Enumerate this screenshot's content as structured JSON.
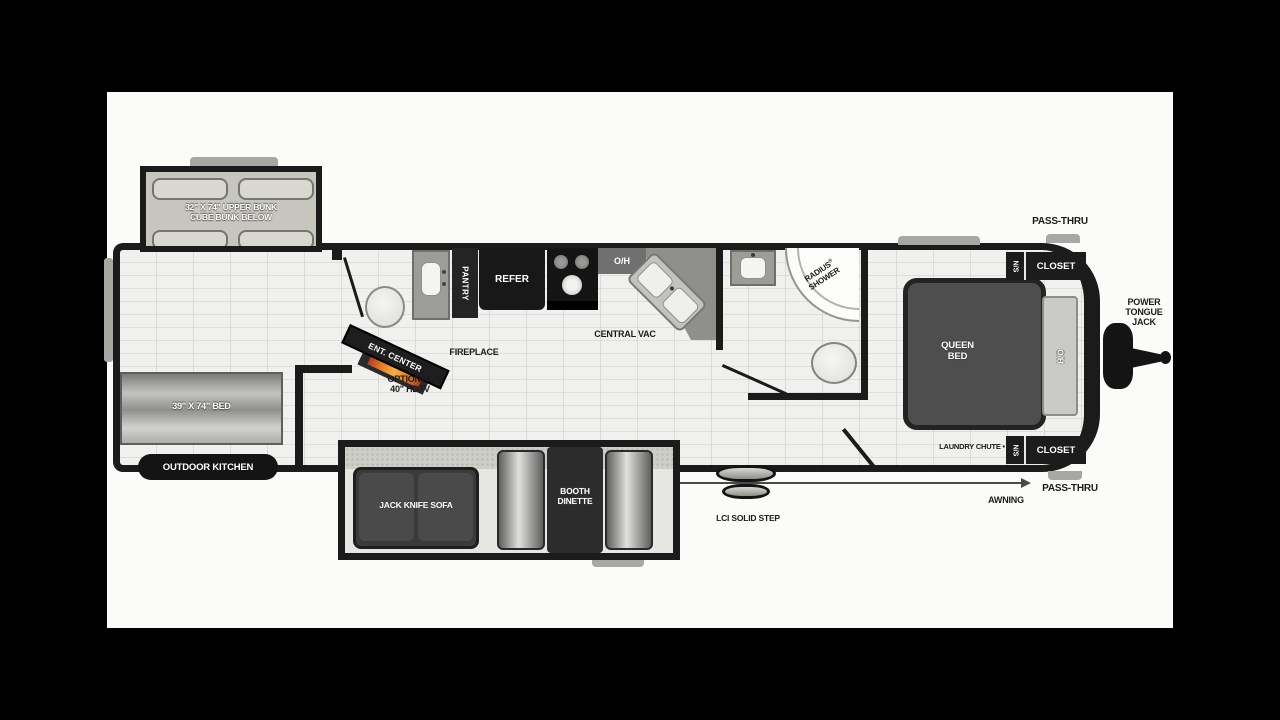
{
  "floorplan": {
    "bunk_slide": {
      "line1": "32\" X 74\" UPPER BUNK",
      "line2": "CUBE BUNK BELOW"
    },
    "rear": {
      "bed": "39\" X 74\" BED",
      "outdoor_kitchen": "OUTDOOR KITCHEN"
    },
    "living": {
      "sofa": "JACK KNIFE SOFA",
      "dinette_line1": "BOOTH",
      "dinette_line2": "DINETTE",
      "fireplace": "FIREPLACE",
      "ent_center": "ENT. CENTER",
      "tv_line1": "OPTIONAL",
      "tv_line2": "40\" HDTV",
      "central_vac": "CENTRAL VAC"
    },
    "kitchen": {
      "pantry": "PANTRY",
      "refer": "REFER",
      "overhead": "O/H"
    },
    "bath": {
      "shower_line1": "RADIUS",
      "shower_reg": "®",
      "shower_line2": "SHOWER"
    },
    "bedroom": {
      "bed_line1": "QUEEN",
      "bed_line2": "BED",
      "overhead": "O/H",
      "ns_top": "N/S",
      "closet_top": "CLOSET",
      "ns_bottom": "N/S",
      "closet_bottom": "CLOSET",
      "laundry": "LAUNDRY CHUTE •"
    },
    "exterior": {
      "pass_thru_top": "PASS-THRU",
      "pass_thru_bottom": "PASS-THRU",
      "awning": "AWNING",
      "jack_line1": "POWER",
      "jack_line2": "TONGUE",
      "jack_line3": "JACK",
      "step": "LCI SOLID STEP"
    }
  },
  "colors": {
    "background": "#000000",
    "canvas": "#fbfbf9",
    "walls": "#1b1b1b",
    "floor": "#eeeeec",
    "flame": "#e67e22",
    "furniture_dark": "#3b3b3b",
    "counter_gray": "#8f8f8b",
    "bed_dark": "#4e4e4e",
    "headboard": "#c9c9c5"
  }
}
